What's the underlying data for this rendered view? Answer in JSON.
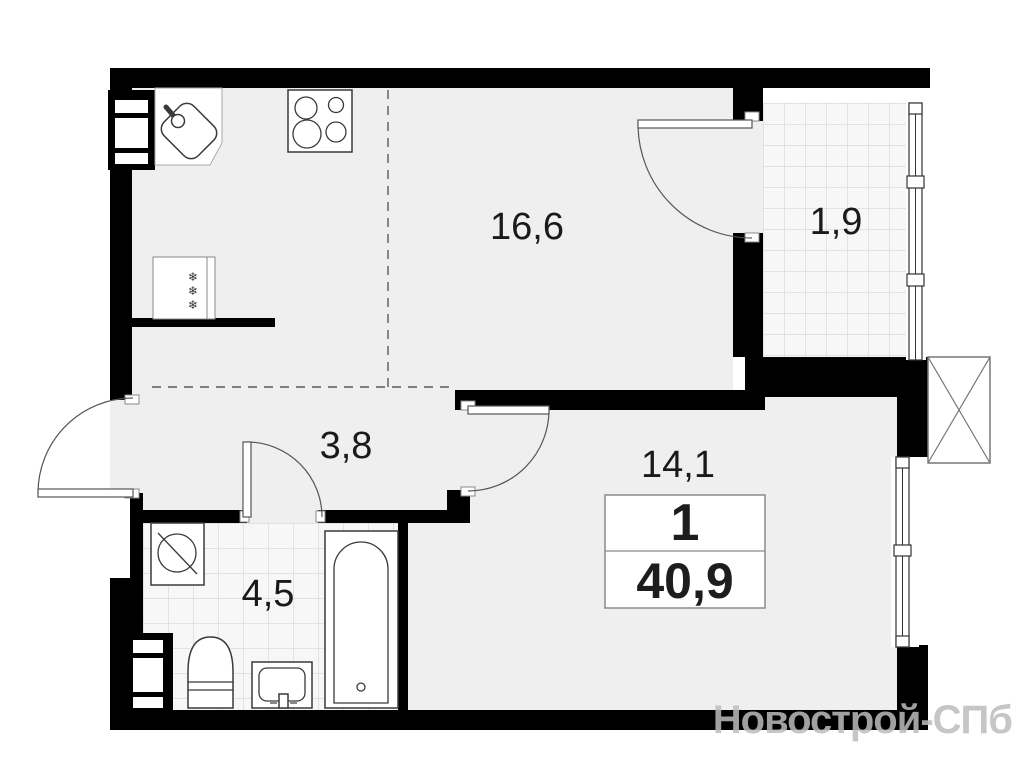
{
  "plan": {
    "title": "one-room apartment floor plan",
    "labels": {
      "kitchen_living": "16,6",
      "balcony": "1,9",
      "hallway": "3,8",
      "bedroom": "14,1",
      "bathroom": "4,5"
    },
    "badge": {
      "rooms": "1",
      "area": "40,9"
    },
    "icons": {
      "snowflake": "❄"
    },
    "watermark": "Новострой-СПб",
    "colors": {
      "wall": "#000000",
      "floor": "#efefef",
      "tile_bg": "#f7f7f7",
      "tile_line": "#cccccc",
      "label_text": "#1a1a1a",
      "watermark": "#bdbdbd"
    }
  }
}
